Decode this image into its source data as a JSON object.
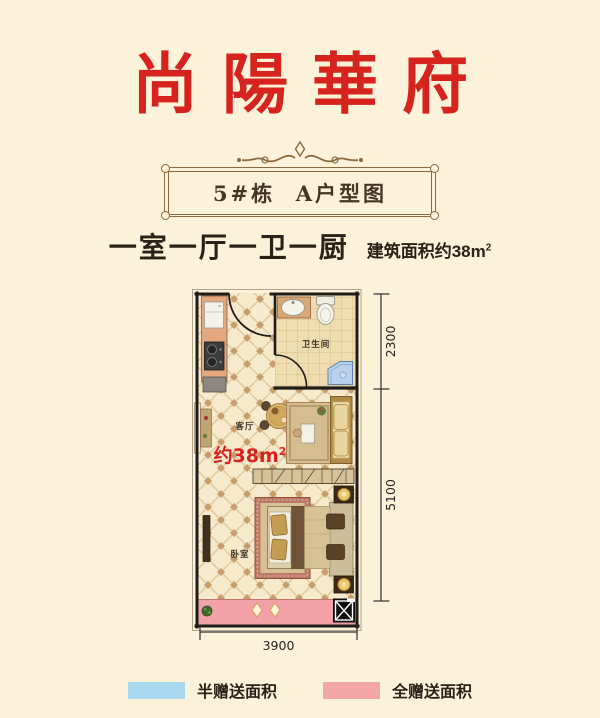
{
  "colors": {
    "background": "#fcf2d9",
    "title_red": "#d7231d",
    "gold": "#8a6a3f",
    "ink": "#2b2117",
    "wall": "#1f1c18",
    "balcony_pink": "#f2a2a6",
    "legend_blue": "#aad9ef",
    "legend_pink": "#f3a6a6"
  },
  "header": {
    "title": "尚陽華府"
  },
  "banner": {
    "label": "5#栋  A户型图"
  },
  "summary": {
    "layout": "一室一厅一卫一厨",
    "area_prefix": "建筑面积约38m",
    "area_sup": "2"
  },
  "floorplan": {
    "labels": {
      "bathroom": "卫生间",
      "living": "客厅",
      "bedroom": "卧室",
      "area_prefix": "约38m",
      "area_sup": "2"
    },
    "dimensions": {
      "right_top": "2300",
      "right_bottom": "5100",
      "bottom": "3900"
    }
  },
  "legend": {
    "items": [
      {
        "label": "半赠送面积",
        "color": "#aad9ef"
      },
      {
        "label": "全赠送面积",
        "color": "#f3a6a6"
      }
    ]
  }
}
